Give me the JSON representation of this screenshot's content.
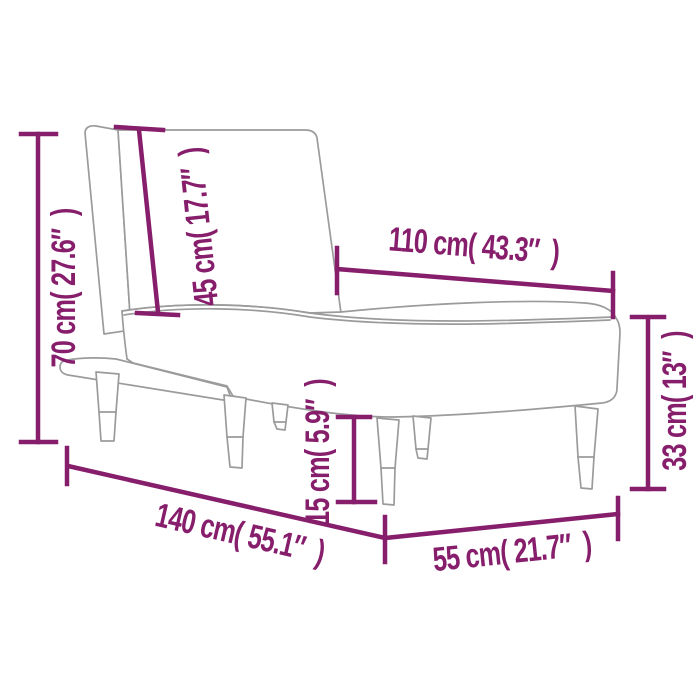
{
  "page": {
    "background_color": "#ffffff",
    "type": "product dimension diagram",
    "product": "chaise longue line drawing"
  },
  "diagram": {
    "accent_color": "#861e6c",
    "outline_color": "#9b9b9b",
    "dimensions": [
      {
        "id": "overall-height",
        "label": "70 cm( 27.6″  )",
        "value_cm": 70,
        "value_in": 27.6,
        "orientation": "vertical-left"
      },
      {
        "id": "backrest-length",
        "label": "45 cm( 17.7″  )",
        "value_cm": 45,
        "value_in": 17.7,
        "orientation": "along-backrest"
      },
      {
        "id": "seat-length",
        "label": "110 cm( 43.3″  )",
        "value_cm": 110,
        "value_in": 43.3,
        "orientation": "along-seat-top"
      },
      {
        "id": "seat-height",
        "label": "33 cm( 13″  )",
        "value_cm": 33,
        "value_in": 13,
        "orientation": "vertical-right"
      },
      {
        "id": "leg-height",
        "label": "15 cm( 5.9″  )",
        "value_cm": 15,
        "value_in": 5.9,
        "orientation": "vertical-middle"
      },
      {
        "id": "overall-length",
        "label": "140 cm( 55.1″  )",
        "value_cm": 140,
        "value_in": 55.1,
        "orientation": "diagonal-bottom-left"
      },
      {
        "id": "overall-width",
        "label": "55 cm( 21.7″  )",
        "value_cm": 55,
        "value_in": 21.7,
        "orientation": "diagonal-bottom-right"
      }
    ]
  }
}
